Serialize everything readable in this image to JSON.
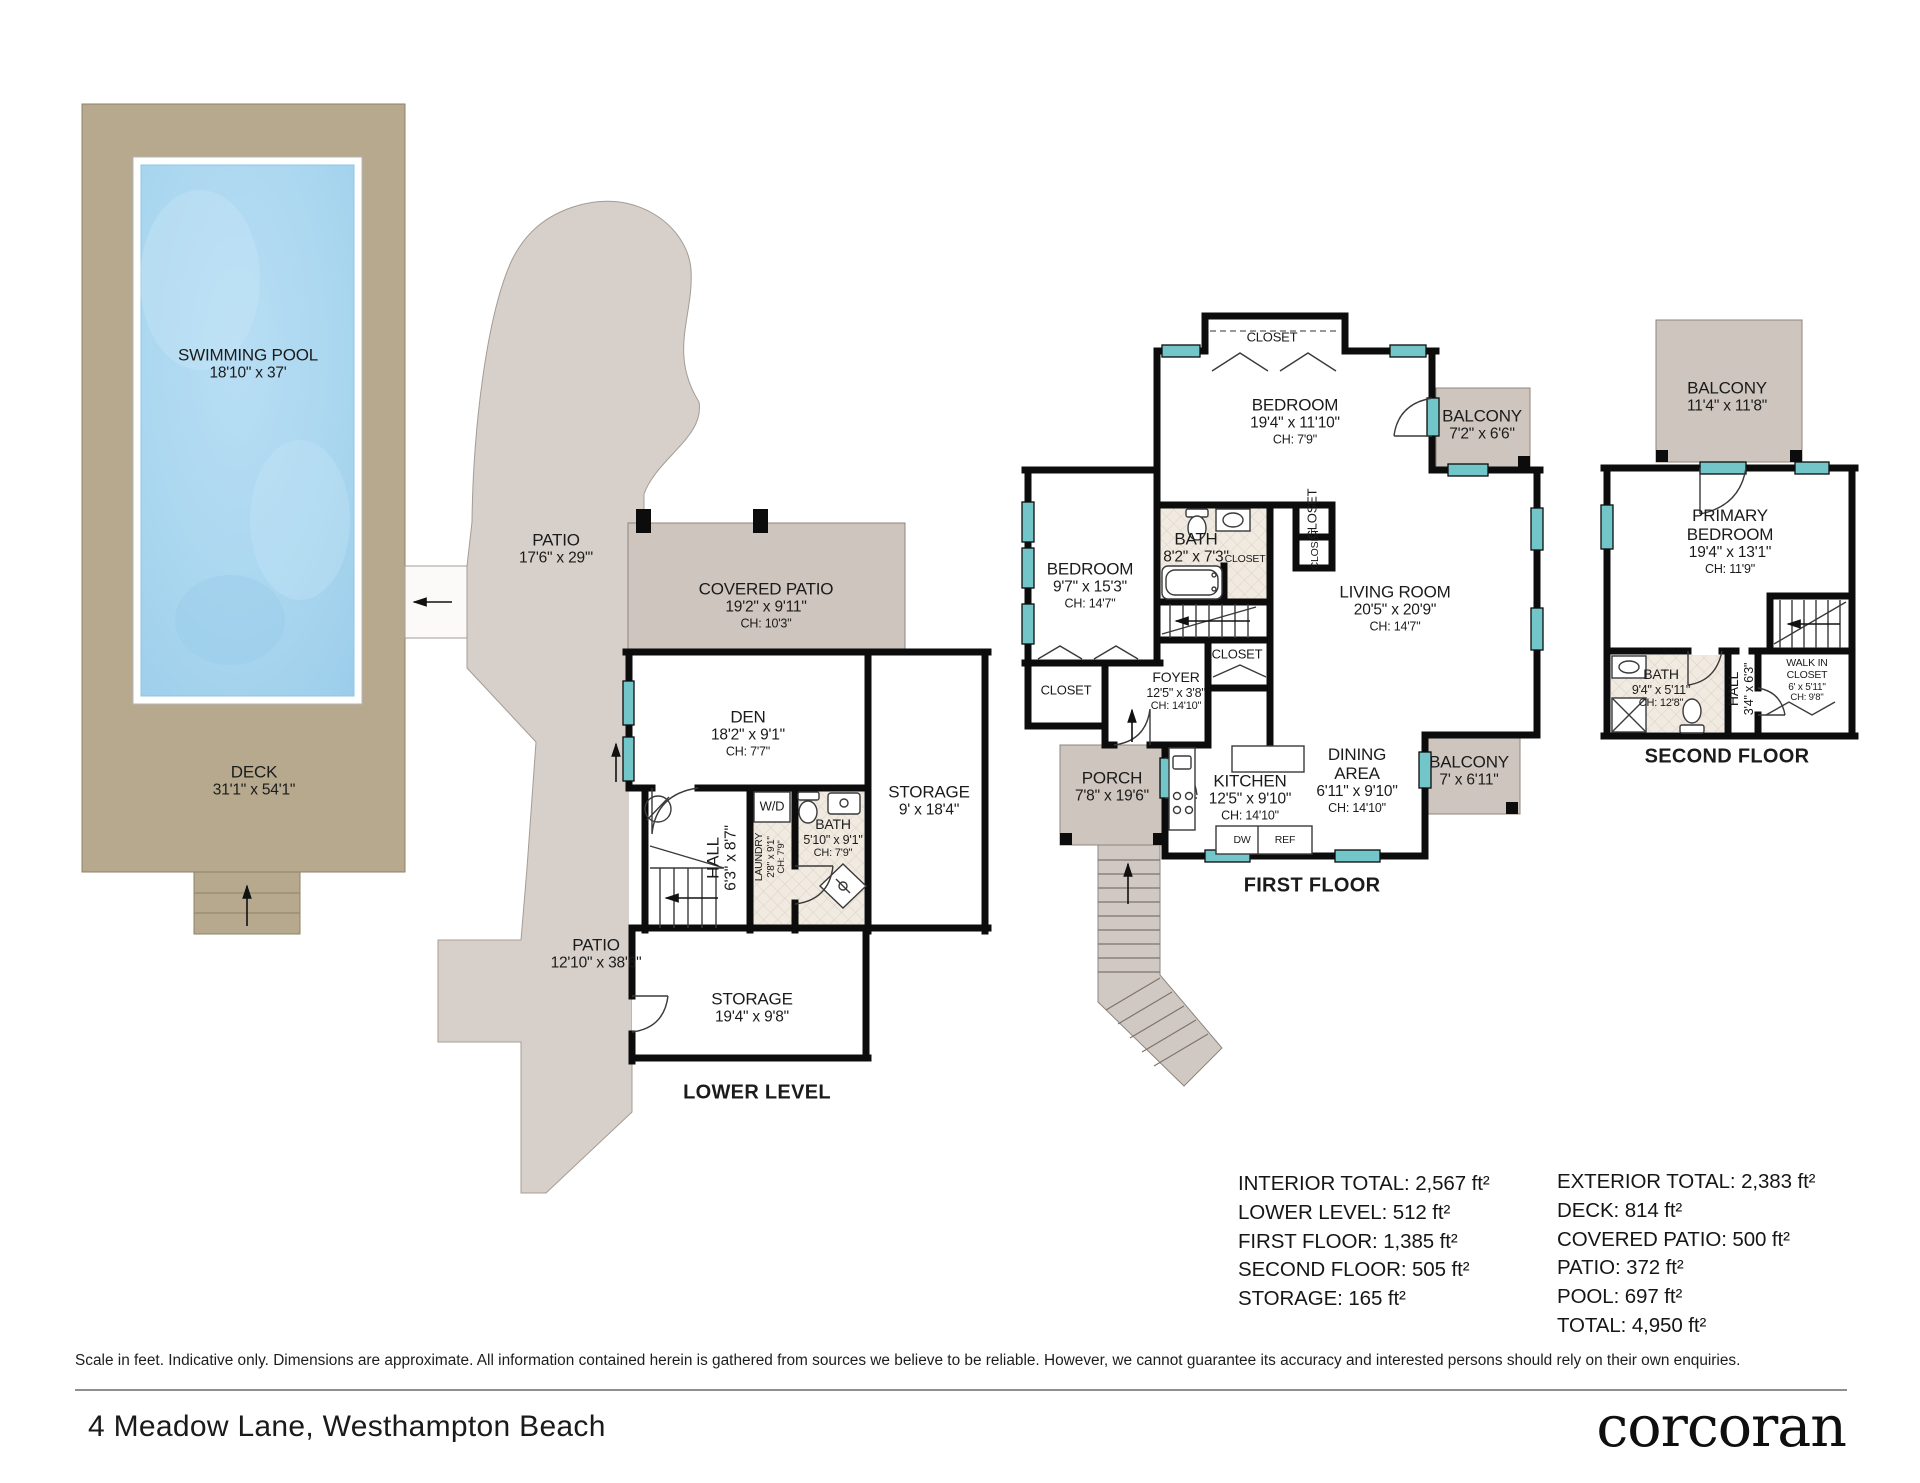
{
  "colors": {
    "deck": "#b6a98e",
    "pool": "#a9d6ef",
    "patio": "#d6cfca",
    "covered_patio": "#cdc5be",
    "wall": "#0c0c0c",
    "window": "#72c6ca",
    "tile": "#f1eae1"
  },
  "floorplan": {
    "labels": [
      {
        "name": "swimming-pool-label",
        "x": 248,
        "y": 364,
        "kind": "room",
        "lines": [
          "SWIMMING POOL",
          "18'10\" x 37'"
        ]
      },
      {
        "name": "deck-label",
        "x": 254,
        "y": 781,
        "kind": "room",
        "lines": [
          "DECK",
          "31'1\" x 54'1\""
        ]
      },
      {
        "name": "patio-upper-label",
        "x": 556,
        "y": 549,
        "kind": "room",
        "lines": [
          "PATIO",
          "17'6\" x 29'\""
        ]
      },
      {
        "name": "covered-patio-label",
        "x": 766,
        "y": 605,
        "kind": "room",
        "lines": [
          "COVERED PATIO",
          "19'2\" x 9'11\"",
          "CH: 10'3\""
        ]
      },
      {
        "name": "patio-lower-label",
        "x": 596,
        "y": 954,
        "kind": "room",
        "lines": [
          "PATIO",
          "12'10\" x 38'6\""
        ]
      },
      {
        "name": "den-label",
        "x": 748,
        "y": 733,
        "kind": "room",
        "lines": [
          "DEN",
          "18'2\" x 9'1\"",
          "CH: 7'7\""
        ]
      },
      {
        "name": "hall-lower-label",
        "x": 722,
        "y": 858,
        "kind": "room",
        "rot": -90,
        "lines": [
          "HALL",
          "6'3\" x 8'7\""
        ]
      },
      {
        "name": "laundry-label",
        "x": 771,
        "y": 857,
        "kind": "tiny",
        "rot": -90,
        "lines": [
          "LAUNDRY",
          "2'8\" x 9'1\"",
          "CH: 7'9\""
        ]
      },
      {
        "name": "washer-dryer-label",
        "x": 772,
        "y": 807,
        "kind": "small",
        "lines": [
          "W/D"
        ]
      },
      {
        "name": "bath-lower-label",
        "x": 833,
        "y": 838,
        "kind": "smallroom",
        "lines": [
          "BATH",
          "5'10\" x 9'1\"",
          "CH: 7'9\""
        ]
      },
      {
        "name": "storage-tall-label",
        "x": 929,
        "y": 801,
        "kind": "room",
        "lines": [
          "STORAGE",
          "9' x 18'4\""
        ]
      },
      {
        "name": "storage-wide-label",
        "x": 752,
        "y": 1008,
        "kind": "room",
        "lines": [
          "STORAGE",
          "19'4\" x 9'8\""
        ]
      },
      {
        "name": "lower-level-title",
        "x": 757,
        "y": 1093,
        "kind": "title",
        "lines": [
          "LOWER LEVEL"
        ]
      },
      {
        "name": "closet-top-label",
        "x": 1272,
        "y": 338,
        "kind": "small",
        "lines": [
          "CLOSET"
        ]
      },
      {
        "name": "bedroom-top-label",
        "x": 1295,
        "y": 421,
        "kind": "room",
        "lines": [
          "BEDROOM",
          "19'4\" x 11'10\"",
          "CH: 7'9\""
        ]
      },
      {
        "name": "balcony-ff-top-label",
        "x": 1482,
        "y": 425,
        "kind": "room",
        "lines": [
          "BALCONY",
          "7'2\" x 6'6\""
        ]
      },
      {
        "name": "bedroom-left-label",
        "x": 1090,
        "y": 585,
        "kind": "room",
        "lines": [
          "BEDROOM",
          "9'7\" x 15'3\"",
          "CH: 14'7\""
        ]
      },
      {
        "name": "bath-ff-label",
        "x": 1196,
        "y": 548,
        "kind": "room",
        "lines": [
          "BATH",
          "8'2\" x 7'3\""
        ]
      },
      {
        "name": "closet-col-label",
        "x": 1313,
        "y": 514,
        "kind": "small",
        "rot": -90,
        "lines": [
          "CLOSET"
        ]
      },
      {
        "name": "closet-col2-label",
        "x": 1316,
        "y": 549,
        "kind": "tiny",
        "rot": -90,
        "lines": [
          "CLOSET"
        ]
      },
      {
        "name": "closet-bath-label",
        "x": 1245,
        "y": 560,
        "kind": "tiny",
        "lines": [
          "CLOSET"
        ]
      },
      {
        "name": "living-room-label",
        "x": 1395,
        "y": 608,
        "kind": "room",
        "lines": [
          "LIVING ROOM",
          "20'5\" x 20'9\"",
          "CH: 14'7\""
        ]
      },
      {
        "name": "closet-bedroom-label",
        "x": 1066,
        "y": 691,
        "kind": "small",
        "lines": [
          "CLOSET"
        ]
      },
      {
        "name": "foyer-label",
        "x": 1176,
        "y": 691,
        "kind": "smallroom",
        "lines": [
          "FOYER",
          "12'5\" x 3'8\"",
          "CH: 14'10\""
        ]
      },
      {
        "name": "closet-foyer-label",
        "x": 1237,
        "y": 655,
        "kind": "small",
        "lines": [
          "CLOSET"
        ]
      },
      {
        "name": "porch-label",
        "x": 1112,
        "y": 787,
        "kind": "room",
        "lines": [
          "PORCH",
          "7'8\" x 19'6\""
        ]
      },
      {
        "name": "kitchen-label",
        "x": 1250,
        "y": 797,
        "kind": "room",
        "lines": [
          "KITCHEN",
          "12'5\" x 9'10\"",
          "CH: 14'10\""
        ]
      },
      {
        "name": "dining-area-label",
        "x": 1357,
        "y": 780,
        "kind": "room",
        "lines": [
          "DINING",
          "AREA",
          "6'11\" x 9'10\"",
          "CH: 14'10\""
        ]
      },
      {
        "name": "balcony-ff-low-label",
        "x": 1469,
        "y": 771,
        "kind": "room",
        "lines": [
          "BALCONY",
          "7' x 6'11\""
        ]
      },
      {
        "name": "dishwasher-label",
        "x": 1242,
        "y": 841,
        "kind": "tiny",
        "lines": [
          "DW"
        ]
      },
      {
        "name": "refrigerator-label",
        "x": 1285,
        "y": 841,
        "kind": "tiny",
        "lines": [
          "REF"
        ]
      },
      {
        "name": "first-floor-title",
        "x": 1312,
        "y": 886,
        "kind": "title",
        "lines": [
          "FIRST FLOOR"
        ]
      },
      {
        "name": "balcony-sf-label",
        "x": 1727,
        "y": 397,
        "kind": "room",
        "lines": [
          "BALCONY",
          "11'4\" x 11'8\""
        ]
      },
      {
        "name": "primary-bedroom-label",
        "x": 1730,
        "y": 541,
        "kind": "room",
        "lines": [
          "PRIMARY",
          "BEDROOM",
          "19'4\" x 13'1\"",
          "CH: 11'9\""
        ]
      },
      {
        "name": "bath-sf-label",
        "x": 1661,
        "y": 688,
        "kind": "smallroom",
        "lines": [
          "BATH",
          "9'4\" x 5'11\"",
          "CH: 12'8\""
        ]
      },
      {
        "name": "hall-sf-label",
        "x": 1741,
        "y": 689,
        "kind": "smallroom",
        "rot": -90,
        "lines": [
          "HALL",
          "3'4\" x 6'3\""
        ]
      },
      {
        "name": "walk-in-closet-label",
        "x": 1807,
        "y": 681,
        "kind": "tiny",
        "lines": [
          "WALK IN",
          "CLOSET",
          "6' x 5'11\"",
          "CH: 9'8\""
        ]
      },
      {
        "name": "second-floor-title",
        "x": 1727,
        "y": 757,
        "kind": "title",
        "lines": [
          "SECOND FLOOR"
        ]
      }
    ]
  },
  "summary": {
    "interior": {
      "x": 1238,
      "y": 1170,
      "lines": [
        "INTERIOR TOTAL: 2,567 ft²",
        "LOWER LEVEL: 512 ft²",
        "FIRST FLOOR: 1,385 ft²",
        "SECOND FLOOR: 505 ft²",
        "STORAGE: 165 ft²"
      ]
    },
    "exterior": {
      "x": 1557,
      "y": 1168,
      "lines": [
        "EXTERIOR TOTAL: 2,383 ft²",
        "DECK: 814 ft²",
        "COVERED PATIO: 500 ft²",
        "PATIO: 372 ft²",
        "POOL: 697 ft²",
        "TOTAL: 4,950 ft²"
      ]
    }
  },
  "footer": {
    "disclaimer": "Scale in feet. Indicative only. Dimensions are approximate. All information contained herein is gathered from sources we believe to be reliable. However, we cannot guarantee its accuracy and interested persons should rely on their own enquiries.",
    "address": "4 Meadow Lane, Westhampton Beach",
    "brand": "corcoran"
  }
}
